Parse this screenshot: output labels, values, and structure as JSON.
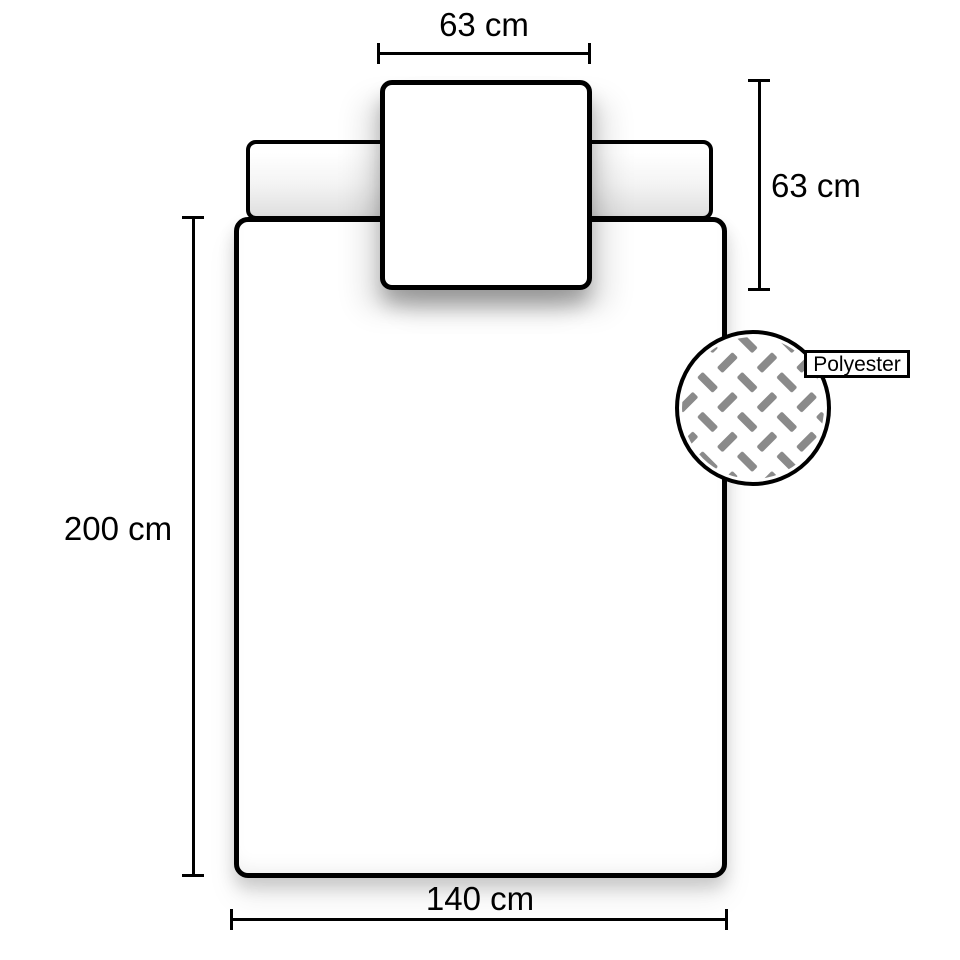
{
  "diagram": {
    "title": "Bedding set dimension diagram",
    "background_color": "#ffffff",
    "outline_color": "#000000",
    "dimensions": {
      "pillow_width": {
        "label": "63 cm",
        "position": "top"
      },
      "pillow_height": {
        "label": "63 cm",
        "position": "right"
      },
      "duvet_length": {
        "label": "200 cm",
        "position": "left"
      },
      "duvet_width": {
        "label": "140 cm",
        "position": "bottom"
      }
    },
    "material": {
      "label": "Polyester",
      "icon": "fabric-weave-icon",
      "weave_color": "#8a8a8a"
    }
  }
}
